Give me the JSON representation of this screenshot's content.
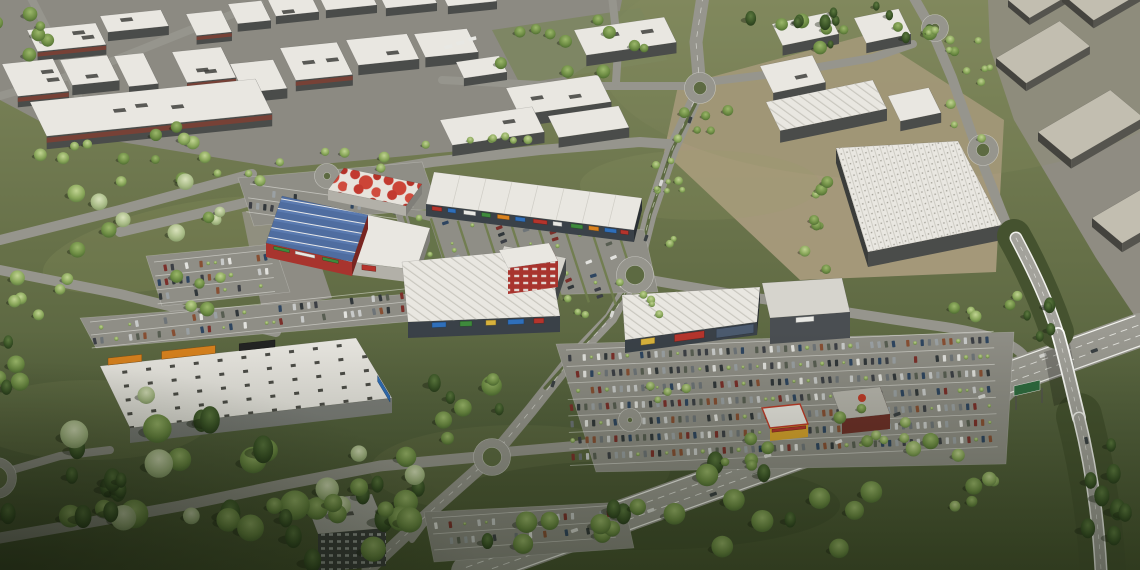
{
  "scene": {
    "kind": "aerial-3d-architectural-render",
    "subject": "Out-of-town retail park with big-box stores and large parking lots, surrounded by an industrial estate, tree-lined access roads with roundabouts, and a motorway interchange with an overpass bridge",
    "legible_text": [],
    "areas": [
      "industrial-estate-northwest",
      "industrial-estate-northeast",
      "context-massing-blocks-east",
      "retail-park-core",
      "hypermarket-solar-roof",
      "mall-roof-deck",
      "retail-strip",
      "anchor-store-with-red-tower",
      "big-box-store-west",
      "big-box-store-east",
      "east-parking-lot",
      "central-parking-lot",
      "west-parking-lot",
      "fast-food-restaurants",
      "office-building",
      "motorway",
      "overpass-bridge",
      "roundabouts",
      "tree-belts",
      "boulevard-with-median"
    ],
    "colors": {
      "grass_light": "#7f875c",
      "grass_mid": "#5d6a42",
      "grass_dark": "#47542f",
      "terrain_mottle": "#9aa06a",
      "lawn": "#7b855c",
      "axis_green": "#66744a",
      "hedge_green": "#6f7d4c",
      "median_green": "#5d6a42",
      "road": "#96958d",
      "road_major": "#9b9a92",
      "marking": "#f4f4ef",
      "apron": "#8c8a82",
      "yard": "#a89a7c",
      "massing_ground": "#8f8c82",
      "roof_white": "#e9e7e1",
      "roof_grey": "#c2beb0",
      "roof_light": "#d6d4cd",
      "wall_dark": "#4a4c4a",
      "wall_charcoal": "#3a4148",
      "wall_grey": "#7e807c",
      "brick": "#7c4034",
      "solar": "#4f6da0",
      "feature_red": "#a8342e",
      "sign_orange": "#d9821e",
      "sign_red": "#b5342c",
      "sign_blue": "#2f6fba",
      "sign_green": "#3e8a3c",
      "sign_yellow": "#d8b23c",
      "sign_white": "#e8e8e4",
      "sign_dark": "#232323",
      "glass_blue": "#4b5a6e",
      "parking": "#8f8e86",
      "embankment": "#45522f",
      "gantry_green": "#2e6b3f",
      "shadow": "rgba(22,28,12,0.38)",
      "car_colors": [
        "#31373a",
        "#6e7478",
        "#c8cac9",
        "#7b2f2a",
        "#2e4560",
        "#585e52",
        "#9aa0a3",
        "#3c3f45",
        "#874f33",
        "#e2e2de"
      ]
    }
  }
}
